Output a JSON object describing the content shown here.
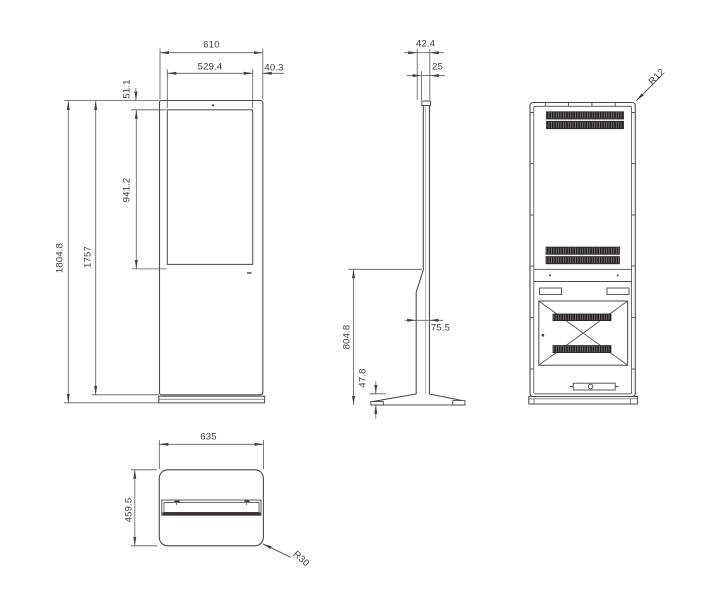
{
  "dimensions": {
    "front_width": "610",
    "screen_width": "529.4",
    "side_offset": "40.3",
    "top_offset": "51.1",
    "screen_height": "941.2",
    "total_height": "1804.8",
    "body_height": "1757",
    "depth_top": "42.4",
    "panel_depth": "25",
    "stand_height": "804.8",
    "pole_depth": "75.5",
    "base_height": "47.8",
    "rear_corner_radius": "R12",
    "base_width": "635",
    "base_depth": "459.5",
    "base_corner_radius": "R30"
  }
}
